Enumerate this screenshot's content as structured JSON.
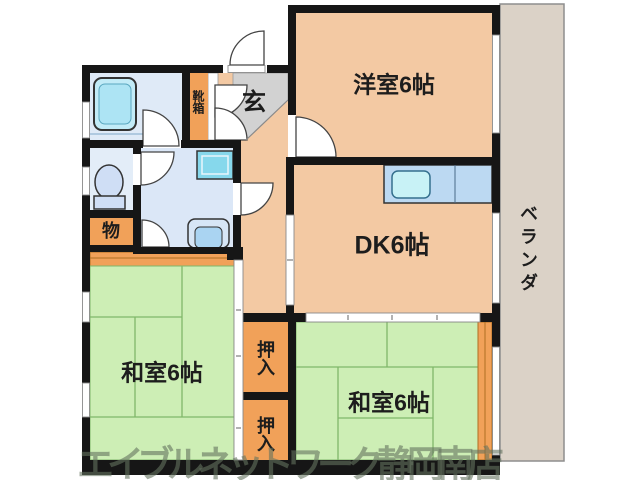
{
  "plan": {
    "western_room": "洋室6帖",
    "dining_kitchen": "DK6帖",
    "japanese_room_left": "和室6帖",
    "japanese_room_right": "和室6帖",
    "closet_upper": "押入",
    "closet_lower": "押入",
    "storage": "物",
    "entrance": "玄",
    "shoe_box": "靴箱",
    "veranda": "ベランダ",
    "watermark": "エイブルネットワーク静岡南店"
  },
  "colors": {
    "wall_black": "#161616",
    "room_peach": "#f3c9a3",
    "tatami_green": "#cdeeb5",
    "tatami_line": "#80b76a",
    "closet_orange": "#f1a159",
    "orange_dark_line": "#b06f24",
    "veranda_beige": "#dbd2c7",
    "entrance_gray": "#d2d2d2",
    "bath_floor_blue": "#dfeaf7",
    "fixture_blue": "#abe7f5",
    "kitchen_counter_blue": "#bcd9f2",
    "watermark_gray_green": "rgba(100,115,95,0.60)"
  }
}
